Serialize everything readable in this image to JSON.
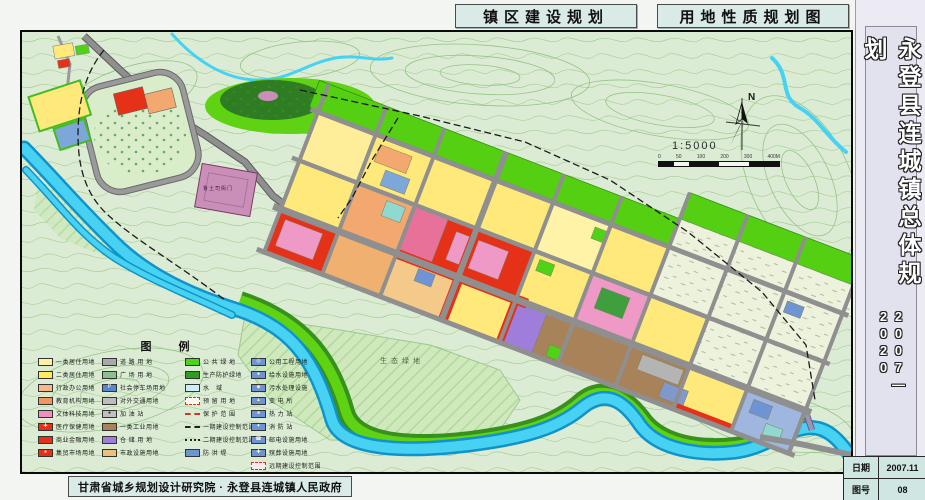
{
  "header": {
    "title_left": "镇区建设规划",
    "title_right": "用地性质规划图"
  },
  "sidebar": {
    "title": "永登县连城镇总体规划",
    "years": "2007—2020",
    "date_label": "日期",
    "date_value": "2007.11",
    "sheet_label": "图号",
    "sheet_value": "08"
  },
  "footer": {
    "credit": "甘肃省城乡规划设计研究院 · 永登县连城镇人民政府"
  },
  "map": {
    "compass_n": "N",
    "scale_text": "1:5000",
    "scale_ticks": [
      "0",
      "50",
      "100",
      "200",
      "300",
      "400M"
    ],
    "labels": {
      "heritage_site": "鲁土司衙门",
      "eco_green": "生态绿地"
    }
  },
  "legend": {
    "title": "图 例",
    "columns": [
      {
        "items": [
          {
            "color": "#ffefa8",
            "label": "一类居住用地"
          },
          {
            "color": "#ffe95c",
            "label": "二类居住用地"
          },
          {
            "color": "#f5b88a",
            "label": "行政办公用地"
          },
          {
            "color": "#f2955e",
            "label": "教育机构用地"
          },
          {
            "color": "#ef8fc0",
            "label": "文体科技用地"
          },
          {
            "color": "#e53117",
            "label": "医疗保健用地",
            "symbol": "✚",
            "symbolColor": "#ffffff"
          },
          {
            "color": "#e53117",
            "label": "商业金融用地"
          },
          {
            "color": "#e53117",
            "label": "集贸市场用地",
            "symbol": "●",
            "symbolColor": "#ffffff"
          }
        ]
      },
      {
        "items": [
          {
            "color": "#a9a9a9",
            "label": "道 路 用 地"
          },
          {
            "color": "#8fbf8f",
            "label": "广 场 用 地"
          },
          {
            "color": "#5588cc",
            "label": "社会停车场用地",
            "symbol": "P",
            "symbolColor": "#ffffff"
          },
          {
            "color": "#bdbdbd",
            "label": "对外交通用地"
          },
          {
            "color": "#c0c0c0",
            "label": "加 油 站",
            "symbol": "●",
            "symbolColor": "#333333"
          },
          {
            "color": "#a8835a",
            "label": "一类工业用地"
          },
          {
            "color": "#9f7ddb",
            "label": "仓 储 用 地"
          },
          {
            "color": "#e8c27a",
            "label": "市政设施用地"
          }
        ]
      },
      {
        "items": [
          {
            "color": "#4ed316",
            "label": "公 共 绿 地"
          },
          {
            "color": "#2e9e1f",
            "label": "生产防护绿地"
          },
          {
            "color": "#c9f0f8",
            "label": "水　域"
          },
          {
            "type": "dashed-box",
            "color": "#f8f8ee",
            "border": "#d23322",
            "label": "预 留 用 地"
          },
          {
            "type": "line",
            "lineStyle": "dashed",
            "lineColor": "#d23322",
            "label": "保 护 范 围"
          },
          {
            "type": "line",
            "lineStyle": "dashed",
            "lineColor": "#222222",
            "label": "一期建设控制范围"
          },
          {
            "type": "line",
            "lineStyle": "dotted",
            "lineColor": "#222222",
            "label": "二期建设控制范围"
          },
          {
            "color": "#6f94d4",
            "label": "防 洪 堤"
          }
        ]
      },
      {
        "items": [
          {
            "color": "#6f94d4",
            "label": "公用工程用地",
            "symbol": "◎",
            "symbolColor": "#ffffff"
          },
          {
            "color": "#6f94d4",
            "label": "给水设施用地",
            "symbol": "●",
            "symbolColor": "#ffffff"
          },
          {
            "color": "#6f94d4",
            "label": "污水处理设施",
            "symbol": "◆",
            "symbolColor": "#ffe0e0"
          },
          {
            "color": "#6f94d4",
            "label": "变 电 所",
            "symbol": "▲",
            "symbolColor": "#ffee88"
          },
          {
            "color": "#6f94d4",
            "label": "热 力 站",
            "symbol": "■",
            "symbolColor": "#ffcccc"
          },
          {
            "color": "#6f94d4",
            "label": "消 防 站",
            "symbol": "✦",
            "symbolColor": "#ffffff"
          },
          {
            "color": "#6f94d4",
            "label": "邮电设施用地",
            "symbol": "☎",
            "symbolColor": "#ffffff"
          },
          {
            "color": "#6f94d4",
            "label": "殡葬设施用地",
            "symbol": "✚",
            "symbolColor": "#ffffff"
          },
          {
            "type": "dashed-box",
            "color": "#fbeaea",
            "border": "#d23322",
            "label": "远期建设控制范围"
          }
        ]
      }
    ]
  },
  "colors": {
    "map_background": "#dcecd4",
    "contour_line": "#9fca8f",
    "river": "#47d2f4",
    "road": "#8f8f8f",
    "green_belt": "#55cf12",
    "commercial_red": "#e53117",
    "residential_yellow": "#ffe97a",
    "industrial_brown": "#a8835a",
    "header_panel": "#d9eae7"
  }
}
